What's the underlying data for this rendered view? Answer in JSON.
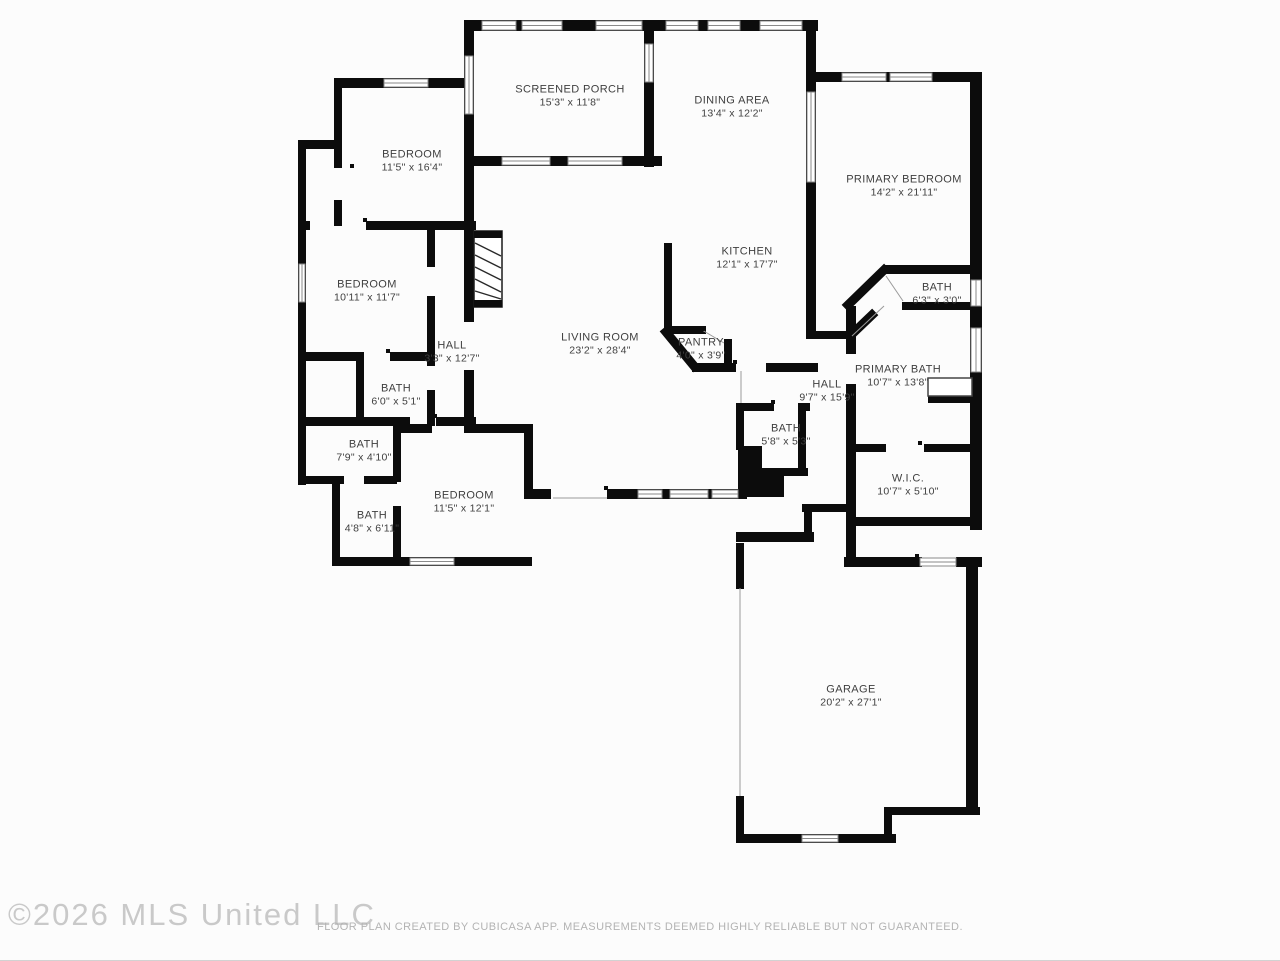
{
  "watermark": "©2026 MLS United LLC",
  "footer": "FLOOR PLAN CREATED BY CUBICASA APP. MEASUREMENTS DEEMED HIGHLY RELIABLE BUT NOT GUARANTEED.",
  "colors": {
    "wall": "#0c0c0c",
    "label": "#3f3f3f",
    "watermark": "#c9c9c9",
    "footer": "#b3b3b3",
    "bg": "#fcfcfc"
  },
  "rooms": [
    {
      "name": "SCREENED PORCH",
      "dims": "15'3\" x 11'8\""
    },
    {
      "name": "DINING AREA",
      "dims": "13'4\" x 12'2\""
    },
    {
      "name": "BEDROOM",
      "dims": "11'5\" x 16'4\""
    },
    {
      "name": "PRIMARY BEDROOM",
      "dims": "14'2\" x 21'11\""
    },
    {
      "name": "KITCHEN",
      "dims": "12'1\" x 17'7\""
    },
    {
      "name": "BEDROOM",
      "dims": "10'11\" x 11'7\""
    },
    {
      "name": "BATH",
      "dims": "6'3\" x 3'0\""
    },
    {
      "name": "LIVING ROOM",
      "dims": "23'2\" x 28'4\""
    },
    {
      "name": "HALL",
      "dims": "3'3\" x 12'7\""
    },
    {
      "name": "PANTRY",
      "dims": "4'0\" x 3'9\""
    },
    {
      "name": "PRIMARY BATH",
      "dims": "10'7\" x 13'8\""
    },
    {
      "name": "BATH",
      "dims": "6'0\" x 5'1\""
    },
    {
      "name": "HALL",
      "dims": "9'7\" x 15'9\""
    },
    {
      "name": "BATH",
      "dims": "7'9\" x 4'10\""
    },
    {
      "name": "BATH",
      "dims": "5'8\" x 5'3\""
    },
    {
      "name": "W.I.C.",
      "dims": "10'7\" x 5'10\""
    },
    {
      "name": "BEDROOM",
      "dims": "11'5\" x 12'1\""
    },
    {
      "name": "BATH",
      "dims": "4'8\" x 6'11\""
    },
    {
      "name": "GARAGE",
      "dims": "20'2\" x 27'1\""
    }
  ]
}
